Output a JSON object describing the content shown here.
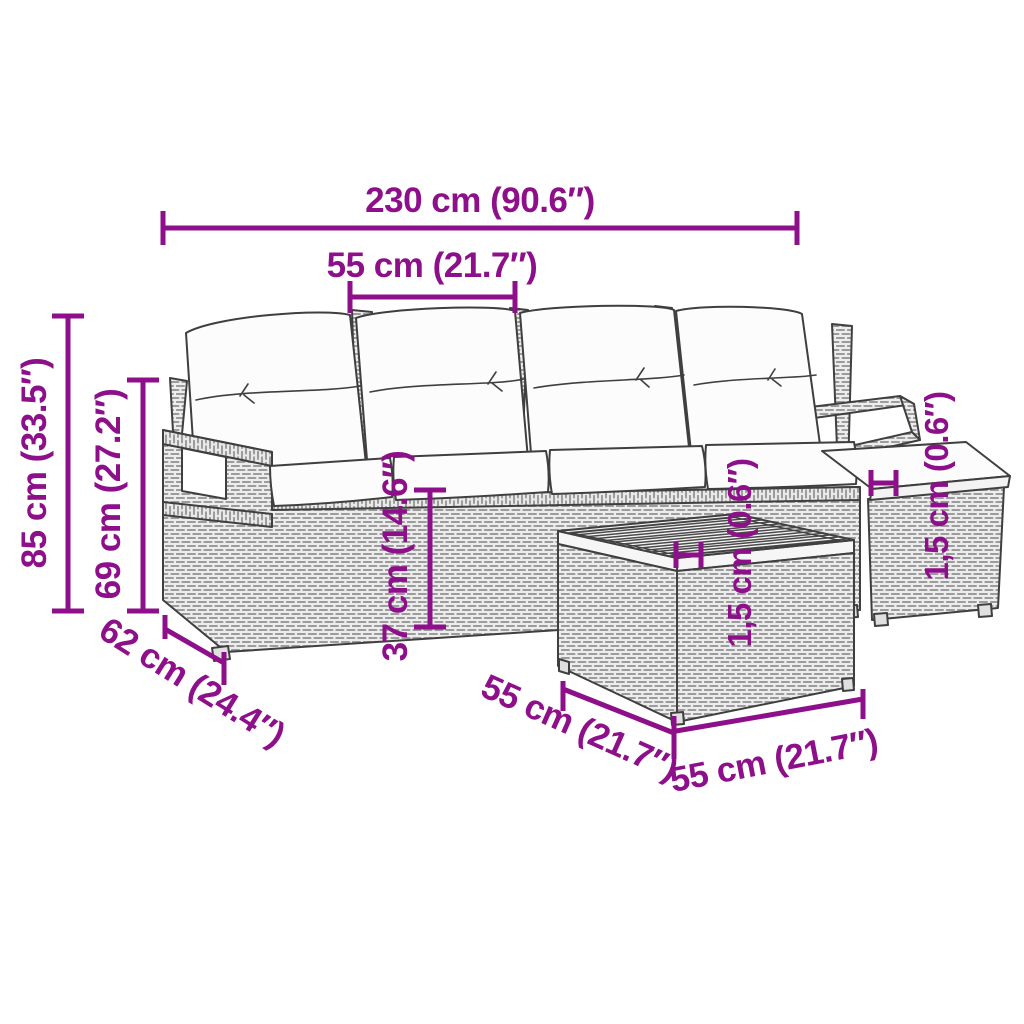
{
  "palette": {
    "dimension": "#8E0F8A",
    "outline": "#3f3f3f",
    "weave": "#9c9c9c",
    "weave_bg": "#ededed",
    "cushion": "#fcfcfc",
    "wood": "#f6f6f6",
    "background": "#ffffff"
  },
  "dimensions": {
    "overall_width": "230 cm (90.6″)",
    "seat_width": "55 cm (21.7″)",
    "overall_height": "85 cm (33.5″)",
    "backrest_height": "69 cm (27.2″)",
    "seat_height": "37 cm (14.6″)",
    "seat_depth": "62 cm (24.4″)",
    "table_width": "55 cm (21.7″)",
    "table_depth": "55 cm (21.7″)",
    "tabletop_thickness": "1,5 cm (0.6″)",
    "cushion_thickness": "1,5 cm (0.6″)"
  }
}
